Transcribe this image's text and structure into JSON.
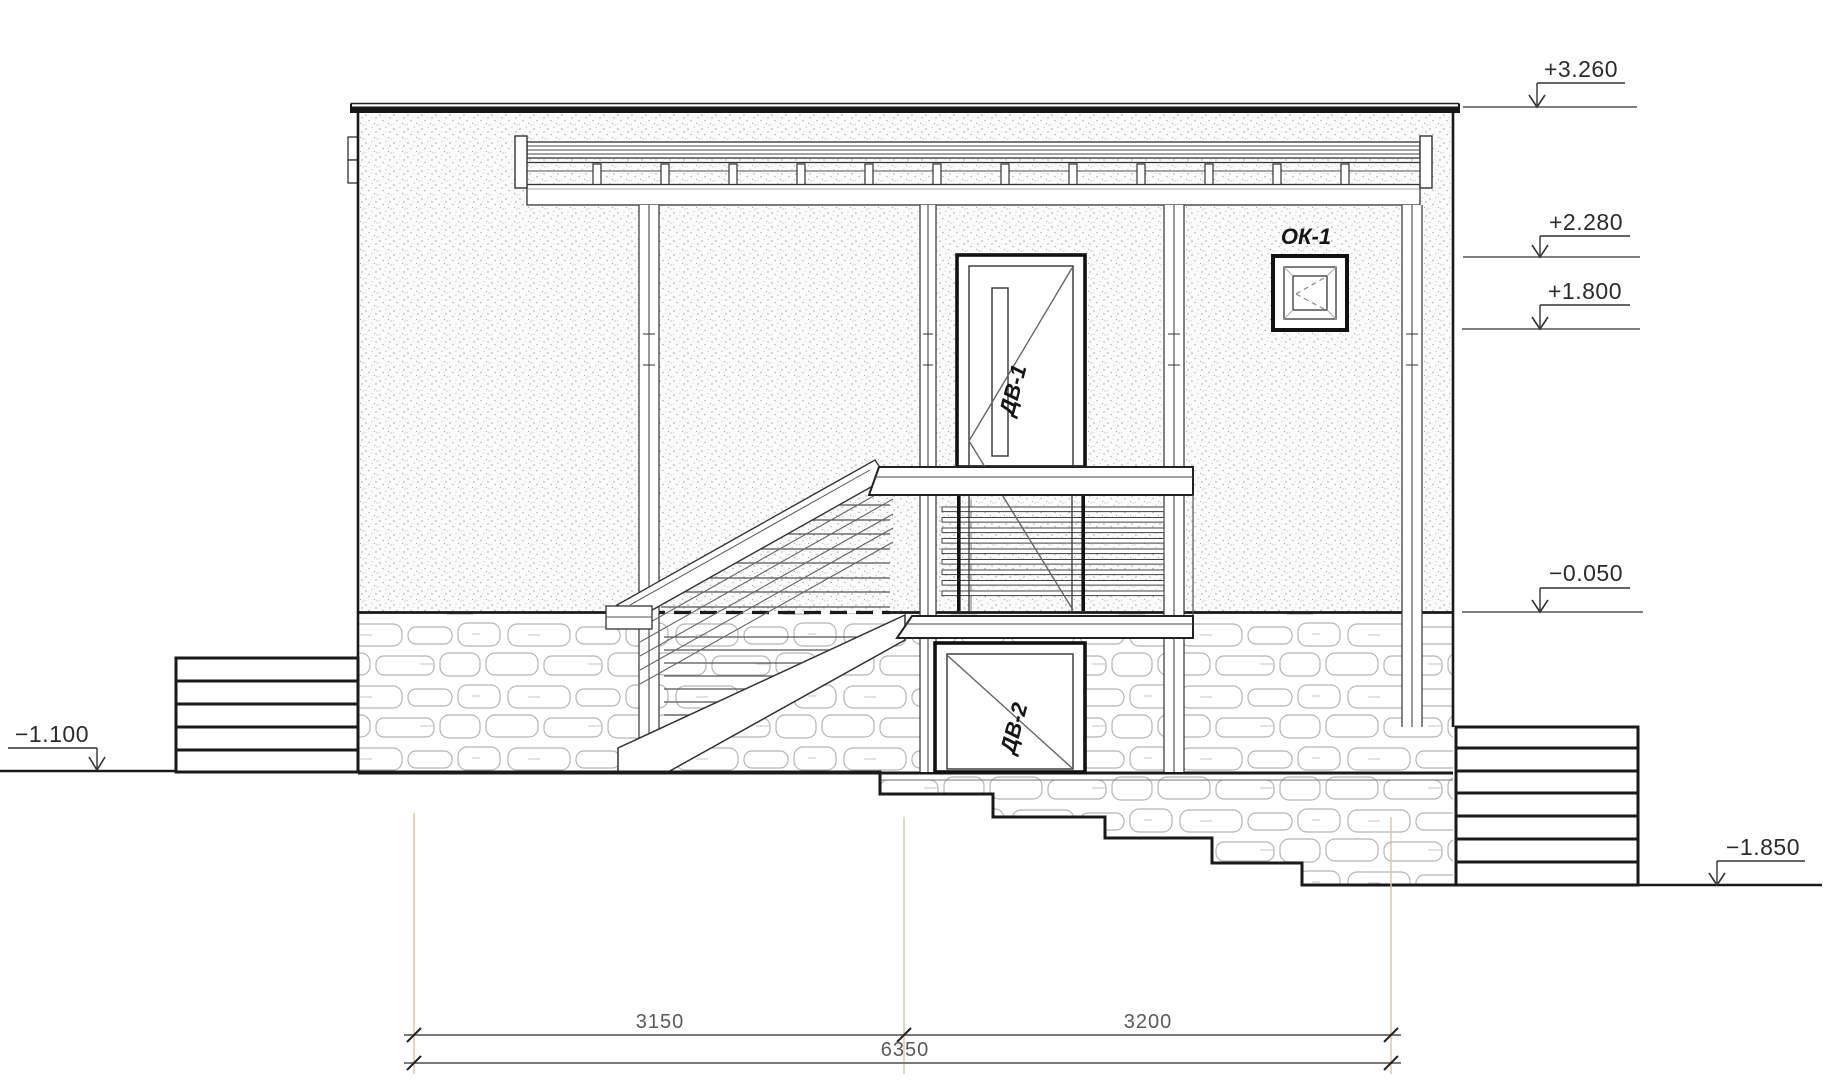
{
  "drawing": {
    "elevation_marks": {
      "roof": "+3.260",
      "canopy_top": "+2.280",
      "window_top": "+1.800",
      "floor": "−0.050",
      "ground_left": "−1.100",
      "ground_right": "−1.850"
    },
    "labels": {
      "window": "ОК-1",
      "door_upper": "ДВ-1",
      "door_lower": "ДВ-2"
    },
    "dimensions": {
      "left_span": "3150",
      "right_span": "3200",
      "total": "6350"
    },
    "colors": {
      "outline": "#1a1a1a",
      "medium_line": "#444444",
      "masonry_line": "#b5b5b5",
      "extension_line": "#dcc2a4",
      "dimension_line": "#7a7a7a"
    }
  }
}
